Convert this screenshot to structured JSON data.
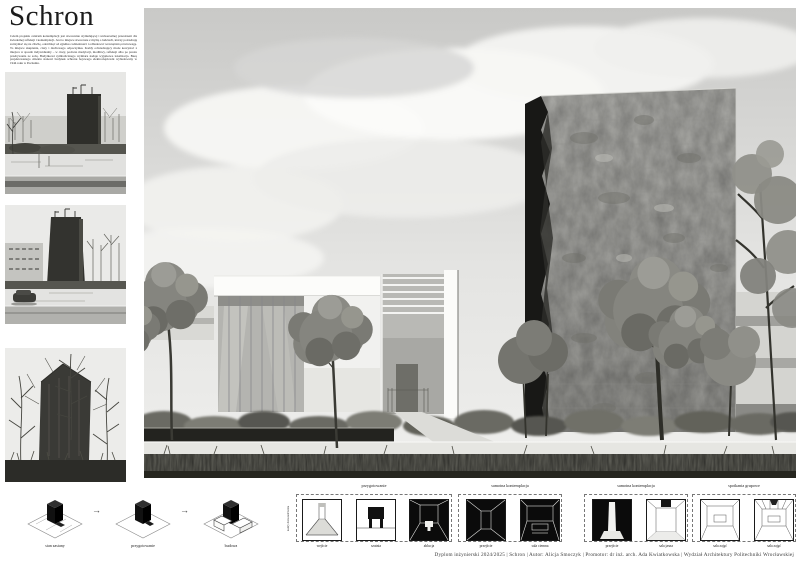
{
  "board": {
    "title": "Schron",
    "description": "Celem projektu centrum kontemplacji jest stworzenie stymulującej i uniwersalnej przestrzeni dla świadomej refleksji i kontemplacji. Jest to miejsce stworzone z myślą o ludziach, którzy potrzebują zatrzymać się na chwilę, odetchnąć od zgiełku codzienności i odbudować wewnętrzną równowagę. To miejsce skupienia, ciszy i duchowego odpoczynku. Każdy odwiedzający może korzystać z miejsca w sposób indywidualny – w ciszy, podczas medytacji, modlitwy, refleksji albo po prostu przebywania ze sobą. Budynkowi symbolicznego wymiaru nadaje wyjątkowa lokalizacja. Bazę projektowanego obiektu stanowi budynek schronu bojowego elektrociepłowni wybudowany w 1944 roku w Poznaniu."
  },
  "process": {
    "steps": [
      "stan zastany",
      "przygotowanie",
      "budowa"
    ],
    "arrow": "→"
  },
  "sequence": {
    "side_label": "kadry doświadczenia",
    "groups": [
      {
        "title": "przygotowanie",
        "cells": [
          {
            "label": "wejście",
            "tone": "light"
          },
          {
            "label": "szatnia",
            "tone": "light"
          },
          {
            "label": "ablucja",
            "tone": "dark"
          }
        ]
      },
      {
        "title": "samotna kontemplacja",
        "cells": [
          {
            "label": "przejście",
            "tone": "dark"
          },
          {
            "label": "sala ciemna",
            "tone": "dark"
          }
        ]
      },
      {
        "title": "samotna kontemplacja",
        "cells": [
          {
            "label": "przejście",
            "tone": "dark"
          },
          {
            "label": "sala jasna",
            "tone": "light"
          }
        ]
      },
      {
        "title": "spotkania grupowe",
        "cells": [
          {
            "label": "sala zajęć",
            "tone": "light"
          },
          {
            "label": "sala zajęć",
            "tone": "light"
          }
        ]
      }
    ]
  },
  "footer": {
    "credit": "Dyplom inżynierski 2024/2025  |  Schron  |  Autor: Alicja Smoczyk  |  Promotor: dr inż. arch. Ada Kwiatkowska  |  Wydział Architektury Politechniki Wrocławskiej"
  },
  "colors": {
    "paper": "#ffffff",
    "ink": "#1c1c1c",
    "concrete": "#a6a6a2",
    "foliage": "#82827c"
  }
}
